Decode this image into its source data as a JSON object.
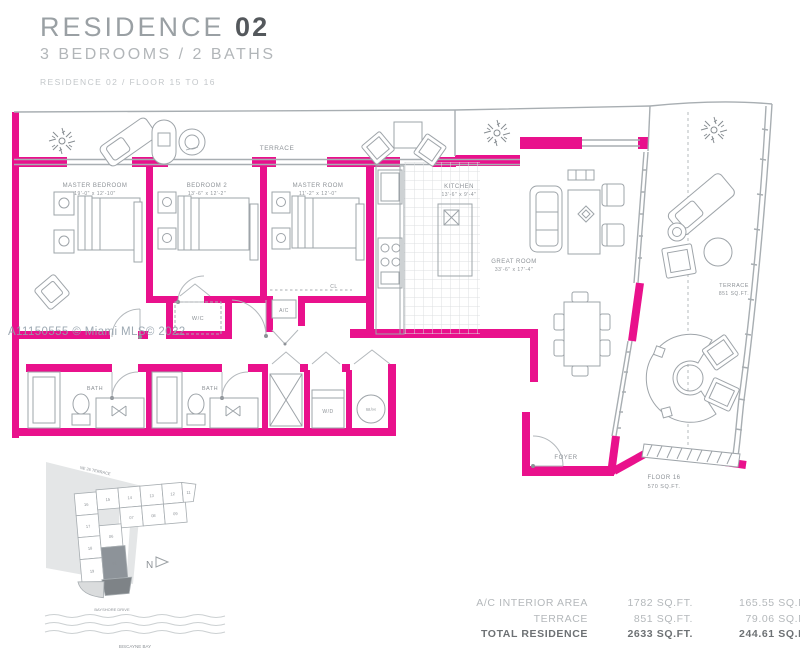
{
  "header": {
    "title": "RESIDENCE",
    "title_number": "02",
    "subtitle": "3 BEDROOMS / 2 BATHS",
    "floor_note": "RESIDENCE 02 / FLOOR 15 TO 16"
  },
  "watermark": "A11150555 © Miami MLS© 2022",
  "colors": {
    "accent": "#E9118C",
    "line": "#A7ADB1",
    "text": "#8D9297"
  },
  "plan": {
    "terrace_top": "TERRACE",
    "master_bedroom": {
      "name": "MASTER BEDROOM",
      "dims": "19'-0\" x 12'-10\""
    },
    "bedroom_2": {
      "name": "BEDROOM 2",
      "dims": "13'-6\" x 12'-2\""
    },
    "master_room": {
      "name": "MASTER ROOM",
      "dims": "11'-2\" x 12'-0\""
    },
    "kitchen": {
      "name": "KITCHEN",
      "dims": "13'-6\" x 9'-4\""
    },
    "great_room": {
      "name": "GREAT ROOM",
      "dims": "33'-6\" x 17'-4\""
    },
    "terrace_right": {
      "name": "TERRACE",
      "area": "851 SQ.FT."
    },
    "floor_16": {
      "name": "FLOOR 16",
      "area": "570 SQ.FT."
    },
    "foyer": "FOYER",
    "bath": "BATH",
    "wc": "W/C",
    "ac": "A/C",
    "wd": "W/D",
    "wh": "W/H",
    "closet": "CL"
  },
  "keyplan": {
    "north": "N",
    "street": "NE 26 TERRACE",
    "drive": "BAYSHORE DRIVE",
    "bay": "BISCAYNE BAY",
    "units": [
      "16",
      "17",
      "18",
      "19",
      "15",
      "14",
      "13",
      "12",
      "11",
      "07",
      "08",
      "09",
      "06",
      "02"
    ]
  },
  "footer": {
    "rows": [
      {
        "label": "A/C INTERIOR AREA",
        "sqft": "1782 SQ.FT.",
        "sqm": "165.55 SQ.M."
      },
      {
        "label": "TERRACE",
        "sqft": "851 SQ.FT.",
        "sqm": "79.06 SQ.M."
      },
      {
        "label": "TOTAL RESIDENCE",
        "sqft": "2633 SQ.FT.",
        "sqm": "244.61 SQ.M."
      }
    ]
  }
}
